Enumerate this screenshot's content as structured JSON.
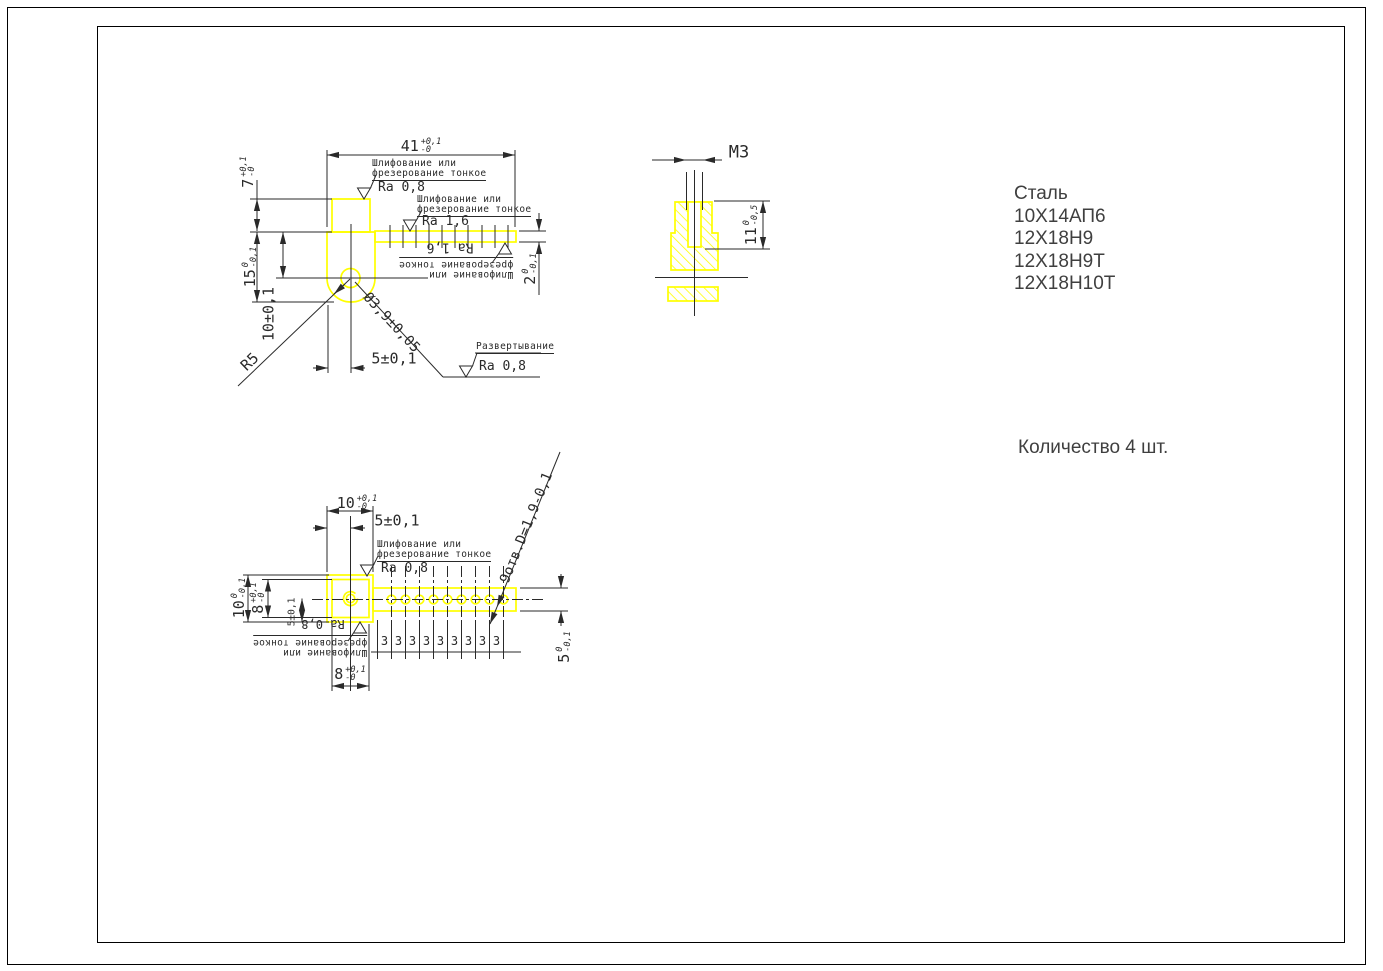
{
  "colors": {
    "part_highlight": "#ffff00",
    "drawing_lines": "#2a2a2a",
    "annotation_text": "#2a2a2a",
    "side_text": "#3f3f3f",
    "background": "#ffffff"
  },
  "materials": {
    "title": "Сталь",
    "grades": [
      "10Х14АП6",
      "12Х18Н9",
      "12Х18Н9Т",
      "12Х18Н10Т"
    ]
  },
  "quantity_note": "Количество 4 шт.",
  "surface_notes": {
    "grind_line1": "Шлифование или",
    "grind_line2": "фрезерование тонкое",
    "ream": "Развертывание",
    "ra_08": "Ra 0,8",
    "ra_16": "Ra 1,6"
  },
  "front_view": {
    "dim_41": {
      "v": "41",
      "up": "+0,1",
      "dn": "-0"
    },
    "dim_7": {
      "v": "7",
      "up": "+0,1",
      "dn": "-0"
    },
    "dim_15": {
      "v": "15",
      "up": "0",
      "dn": "-0,1"
    },
    "dim_10": "10±0,1",
    "dim_5": "5±0,1",
    "dim_2": {
      "v": "2",
      "up": "0",
      "dn": "-0,1"
    },
    "radius": "R5",
    "hole_dia": "Ø3,9±0,05"
  },
  "section_view": {
    "thread": "M3",
    "dim_11": {
      "v": "11",
      "up": "0",
      "dn": "-0,5"
    }
  },
  "top_view": {
    "dim_10_top": {
      "v": "10",
      "up": "+0,1",
      "dn": "-0"
    },
    "dim_5_top": "5±0,1",
    "dim_10_left": {
      "v": "10",
      "up": "0",
      "dn": "-0,1"
    },
    "dim_8_left": {
      "v": "8",
      "up": "+0,1",
      "dn": "-0"
    },
    "dim_5_small": "5±0,1",
    "dim_8_bottom": {
      "v": "8",
      "up": "+0,1",
      "dn": "-0"
    },
    "dim_5_right": {
      "v": "5",
      "up": "0",
      "dn": "-0,1"
    },
    "holes_note": "9отв.D=1,9-0,1",
    "spacing": [
      "3",
      "3",
      "3",
      "3",
      "3",
      "3",
      "3",
      "3",
      "3"
    ]
  }
}
